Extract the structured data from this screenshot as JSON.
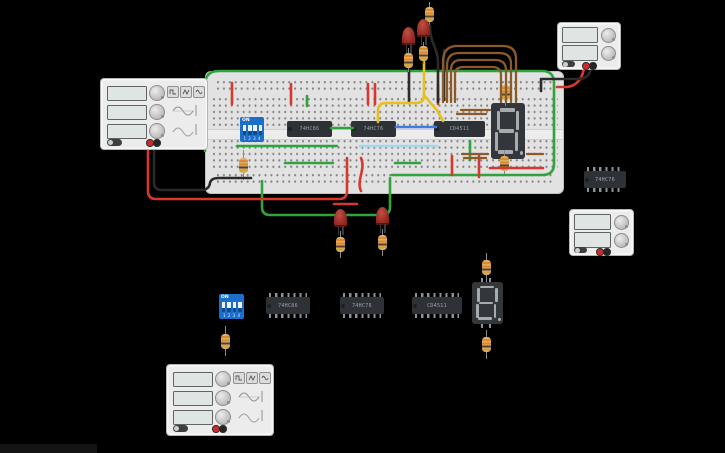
{
  "scene": {
    "background": "#000000",
    "bottom_bar_color": "#141414"
  },
  "palette": {
    "wire_green": "#2fa43c",
    "wire_red": "#d6382e",
    "wire_black": "#2a2a2a",
    "wire_yellow": "#e6c119",
    "wire_blue": "#3d7de0",
    "wire_cyan": "#a5d8ef",
    "wire_brown": "#8a5a2b",
    "board_body": "#e2e2e2",
    "ic_body": "#2e3135",
    "dip_blue": "#1b6ec9",
    "led_red": "#9e2b20",
    "resistor_body": "#d8b06a",
    "device_body": "#ececec",
    "display_body": "#33373c",
    "display_off_segment": "#a7abae"
  },
  "ics": {
    "onboard": [
      {
        "label": "74HC86"
      },
      {
        "label": "74HC76"
      },
      {
        "label": "CD4511"
      }
    ],
    "loose": [
      {
        "label": "74HC86"
      },
      {
        "label": "74HC76"
      },
      {
        "label": "CD4511"
      }
    ],
    "right": {
      "label": "74HC76"
    }
  },
  "dip_switch": {
    "on_label": "ON",
    "positions": "1 2 3 4"
  },
  "seven_segment": {
    "value": "8."
  }
}
